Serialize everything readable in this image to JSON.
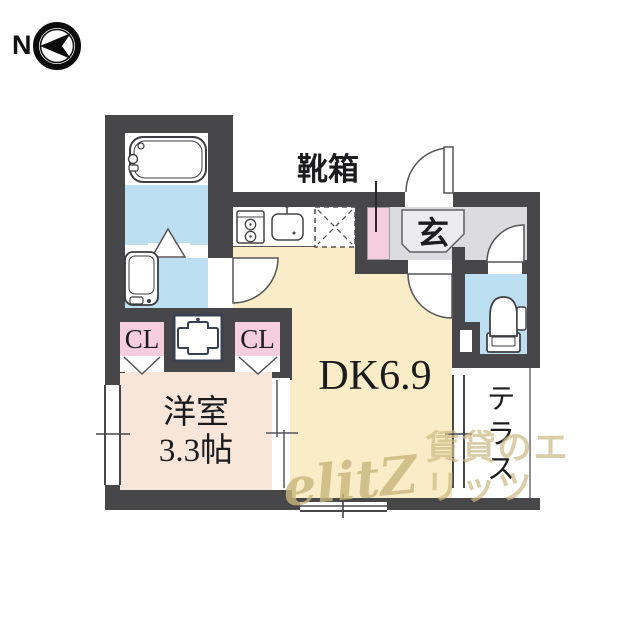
{
  "compass": {
    "north_label": "N"
  },
  "rooms": {
    "dining_kitchen": {
      "label": "DK6.9"
    },
    "western_room": {
      "label_line1": "洋室",
      "label_line2": "3.3帖"
    },
    "entrance": {
      "label": "玄"
    },
    "terrace": {
      "label": "テラス"
    },
    "closet_left": {
      "label": "CL"
    },
    "closet_right": {
      "label": "CL"
    },
    "shoe_box": {
      "label": "靴箱"
    }
  },
  "watermark": {
    "logo": "elitZ",
    "company": "賃貸のエリッツ"
  },
  "colors": {
    "wall": "#47474a",
    "dk_floor": "#f9ecc6",
    "western_room_floor": "#f9e6da",
    "wet_area_floor": "#bcdff2",
    "closet_fill": "#f6cede",
    "shoe_box_fill": "#f5cede",
    "entrance_floor": "#dcdcde",
    "watermark": "#cdb984"
  }
}
